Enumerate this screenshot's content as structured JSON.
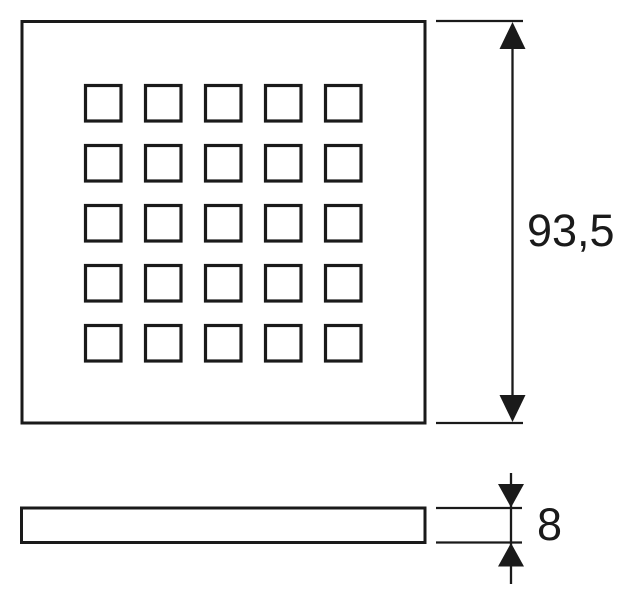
{
  "page": {
    "background_color": "#ffffff",
    "line_color": "#1a1a1a"
  },
  "drawing": {
    "kind": "technical-dimension-drawing",
    "front_view": {
      "description": "square grate face with grid of square perforations",
      "hole_grid": {
        "rows": 5,
        "cols": 5,
        "hole_shape": "square",
        "hole_count": 25
      }
    },
    "side_view": {
      "description": "thin flat profile bar"
    },
    "dimensions": [
      {
        "id": "height",
        "label": "93,5",
        "applies_to": "front-view-height",
        "arrow_style": "filled-triangle-double"
      },
      {
        "id": "thickness",
        "label": "8",
        "applies_to": "side-view-thickness",
        "arrow_style": "filled-triangle-inward"
      }
    ]
  }
}
